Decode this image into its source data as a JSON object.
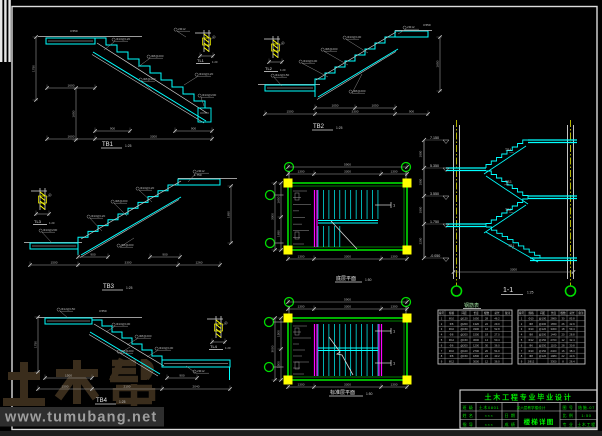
{
  "colors": {
    "cyan": "#00ffff",
    "green": "#00ff00",
    "bubble_green": "#00dd00",
    "yellow": "#ffff00",
    "magenta": "#ff00ff",
    "line": "#d4d4d4",
    "dim_line": "#a6a6a6",
    "dim_text": "#bdbdbd",
    "brand_brown": "#3a2d1c",
    "band_gray": "#2e2e2e"
  },
  "watermark": {
    "brand": "土木帮",
    "url": "www.tumubang.net"
  },
  "plans": {
    "section_mark": "1",
    "plan1": {
      "title": "底层平面",
      "scale": "1:50",
      "dims": {
        "total_w": "5900",
        "top": [
          "1300",
          "3300",
          "1300"
        ],
        "left": [
          "1650",
          "1650"
        ],
        "total_h": "3300",
        "bottom": [
          "1300",
          "3300",
          "1300"
        ]
      }
    },
    "plan2": {
      "title": "标准层平面",
      "scale": "1:50",
      "dims": {
        "total_w": "5900",
        "top": [
          "1300",
          "3300",
          "1300"
        ],
        "left": [
          "1500",
          "1500"
        ],
        "total_h": "3000",
        "bottom": [
          "1300",
          "3300",
          "1300"
        ]
      }
    }
  },
  "stairs": {
    "tb1": {
      "title": "TB1",
      "scale": "1:25",
      "level": "3.550",
      "callouts": [
        "Φ10@120",
        "Φ8@200",
        "Φ10@120",
        "Φ8@200",
        "Φ10@200",
        "2Φ12"
      ],
      "dims": {
        "top_segs": [
          "900",
          "900"
        ],
        "bottom": [
          "1600",
          "3300"
        ],
        "landing": "1600",
        "height": "1650",
        "left": "1750"
      }
    },
    "tb2": {
      "title": "TB2",
      "scale": "1:25",
      "level": "3.550",
      "callouts": [
        "Φ10@100",
        "Φ8@200",
        "Φ10@100",
        "Φ8@200",
        "Φ12@150",
        "2Φ12"
      ],
      "dims": {
        "top_segs": [
          "1050",
          "1050"
        ],
        "bottom": [
          "1500",
          "3300",
          "900"
        ],
        "height": "1650"
      }
    },
    "tb3": {
      "title": "TB3",
      "scale": "1:25",
      "level": "1.750",
      "callouts": [
        "Φ10@120",
        "Φ8@200",
        "Φ10@120",
        "Φ8@200",
        "Φ10@200",
        "2Φ12"
      ],
      "dims": {
        "top_segs": [
          "900",
          "900"
        ],
        "bottom": [
          "1500",
          "3300",
          "1260"
        ],
        "height": "1650"
      }
    },
    "tb4": {
      "title": "TB4",
      "scale": "1:25",
      "level": "3.550",
      "callouts": [
        "Φ10@100",
        "Φ8@200",
        "Φ10@100",
        "Φ8@200",
        "Φ12@150",
        "2Φ12"
      ],
      "dims": {
        "top_segs": [
          "1500",
          "900"
        ],
        "bottom": [
          "1500",
          "2100",
          "2040"
        ],
        "left": "1750"
      }
    }
  },
  "details": {
    "tl1": {
      "label": "TL1",
      "scale": "1:20"
    },
    "tl2": {
      "label": "TL2",
      "scale": "1:20"
    },
    "tl3": {
      "label": "TL3",
      "scale": "1:20"
    },
    "tl4": {
      "label": "TL4",
      "scale": "1:20"
    }
  },
  "section": {
    "title": "1-1",
    "scale": "1:25",
    "levels": [
      "7.150",
      "5.350",
      "3.550",
      "1.750",
      "-0.050"
    ],
    "flight_labels": [
      "TB4",
      "TB3",
      "TB2",
      "TB1"
    ],
    "dims": {
      "floors": [
        "1800",
        "1800",
        "1800",
        "2200"
      ],
      "bottom": "3300"
    }
  },
  "tables": {
    "title": "钢筋表",
    "left": {
      "rows": [
        [
          "编号",
          "规格",
          "间距",
          "长度",
          "根数",
          "总长",
          "备注"
        ],
        [
          "1",
          "Φ10",
          "@120",
          "1650",
          "28",
          "46.2",
          ""
        ],
        [
          "2",
          "Φ8",
          "@200",
          "1320",
          "22",
          "29.0",
          ""
        ],
        [
          "3",
          "Φ10",
          "@150",
          "3300",
          "16",
          "52.8",
          ""
        ],
        [
          "4",
          "Φ8",
          "@200",
          "1500",
          "18",
          "27.0",
          ""
        ],
        [
          "5",
          "Φ12",
          "@150",
          "3600",
          "14",
          "50.4",
          ""
        ],
        [
          "6",
          "Φ6",
          "@200",
          "1200",
          "30",
          "36.0",
          ""
        ],
        [
          "7",
          "Φ10",
          "@100",
          "2700",
          "20",
          "54.0",
          ""
        ],
        [
          "8",
          "Φ8",
          "@150",
          "1800",
          "24",
          "43.2",
          ""
        ],
        [
          "9",
          "Φ12",
          "",
          "3000",
          "12",
          "36.0",
          ""
        ]
      ]
    },
    "right": {
      "rows": [
        [
          "编号",
          "规格",
          "间距",
          "长度",
          "根数",
          "总长",
          "备注"
        ],
        [
          "1",
          "Φ10",
          "@100",
          "2860",
          "30",
          "85.8",
          ""
        ],
        [
          "2",
          "Φ8",
          "@200",
          "1650",
          "26",
          "42.9",
          ""
        ],
        [
          "3",
          "Φ10",
          "@120",
          "3300",
          "18",
          "59.4",
          ""
        ],
        [
          "4",
          "Φ8",
          "@200",
          "1440",
          "20",
          "28.8",
          ""
        ],
        [
          "5",
          "Φ12",
          "@150",
          "2700",
          "12",
          "32.4",
          ""
        ],
        [
          "6",
          "Φ6",
          "@250",
          "1100",
          "28",
          "30.8",
          ""
        ],
        [
          "7",
          "Φ10",
          "@150",
          "2400",
          "16",
          "38.4",
          ""
        ],
        [
          "8",
          "Φ8",
          "@120",
          "1980",
          "22",
          "43.6",
          ""
        ],
        [
          "9",
          "2Φ12",
          "",
          "3300",
          "8",
          "26.4",
          ""
        ]
      ]
    }
  },
  "titleblock": {
    "title": "土木工程专业毕业设计",
    "project": "某六层教学楼设计",
    "drawing_name": "楼梯详图",
    "cells": {
      "r1a": "班 级",
      "r1b": "土木0801",
      "r1e": "图 号",
      "r1f": "结施-07",
      "r2a": "姓 名",
      "r2b": "×××",
      "r2c": "日 期",
      "r2e": "比 例",
      "r2f": "1:50",
      "r3a": "指 导",
      "r3b": "×××",
      "r3c": "成 绩",
      "r3e": "专 业",
      "r3f": "土木工程"
    }
  }
}
